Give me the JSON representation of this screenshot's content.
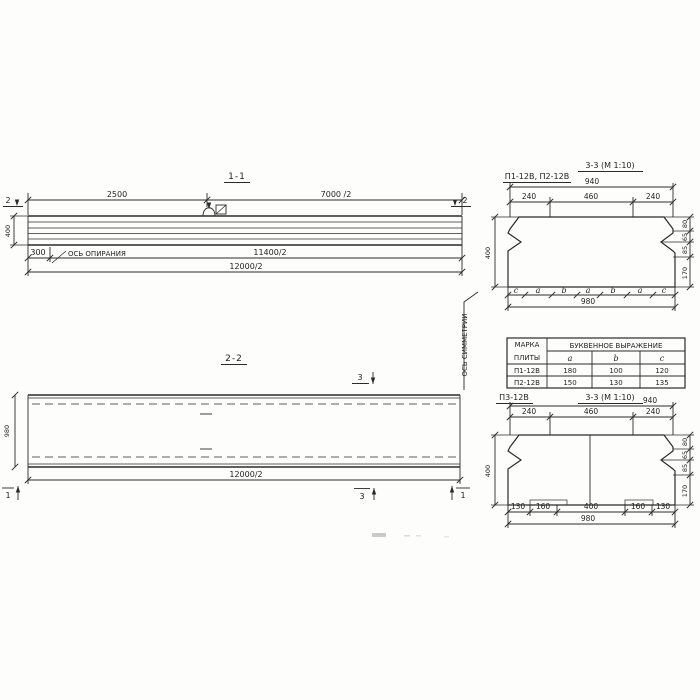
{
  "sec11": {
    "title": "1-1",
    "d_2500": "2500",
    "d_7000": "7000 /2",
    "d_h400": "400",
    "d_300": "300",
    "d_11400": "11400/2",
    "d_12000": "12000/2",
    "axis_label": "ОСЬ ОПИРАНИЯ",
    "cut_mark": "2"
  },
  "sec22": {
    "title": "2-2",
    "d_980": "980",
    "d_12000": "12000/2",
    "axis_label": "ОСЬ СИММЕТРИИ",
    "cut_mark_1": "1",
    "cut_mark_3": "3"
  },
  "sec33a": {
    "label": "П1-12В, П2-12В",
    "title": "3-3 (М 1:10)",
    "d_940": "940",
    "d_240l": "240",
    "d_460": "460",
    "d_240r": "240",
    "d_400": "400",
    "d_980": "980",
    "r_80": "80",
    "r_65": "65",
    "r_85": "85",
    "r_170": "170",
    "letters": [
      "c",
      "a",
      "b",
      "a",
      "b",
      "a",
      "c"
    ]
  },
  "slab_table": {
    "col1_line1": "МАРКА",
    "col1_line2": "ПЛИТЫ",
    "span_header": "БУКВЕННОЕ  ВЫРАЖЕНИЕ",
    "cols": [
      "a",
      "b",
      "c"
    ],
    "rows": [
      [
        "П1-12В",
        "180",
        "100",
        "120"
      ],
      [
        "П2-12В",
        "150",
        "130",
        "135"
      ]
    ]
  },
  "sec33b": {
    "label": "П3-12В",
    "title": "3-3 (М 1:10)",
    "d_940": "940",
    "d_240l": "240",
    "d_460": "460",
    "d_240r": "240",
    "d_400": "400",
    "d_980": "980",
    "r_80": "80",
    "r_65": "65",
    "r_85": "85",
    "r_170": "170",
    "b_130l": "130",
    "b_160l": "160",
    "b_400": "400",
    "b_160r": "160",
    "b_130r": "130"
  }
}
